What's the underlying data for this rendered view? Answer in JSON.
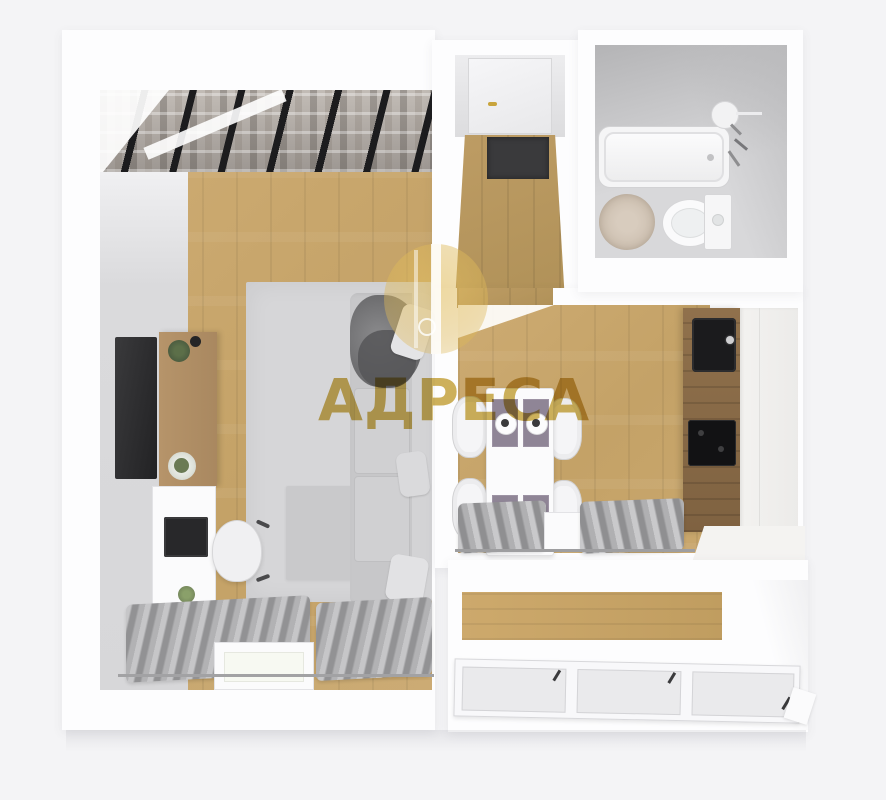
{
  "watermark": {
    "brand": "АДРЕСА",
    "icon": "lightbulb-icon",
    "brand_color": "#c9a63f"
  },
  "palette": {
    "page_background": "#f4f4f6",
    "walls_white": "#fdfdfe",
    "wood_floor": "#c9a76d",
    "hall_wood": "#b49459",
    "kitchen_counter_wood": "#8b6c49",
    "curtain_gray": "#a4a4a6",
    "appliance_dark": "#1b1b1d",
    "rug_gray": "#d6d6d8",
    "bath_rug_beige": "#cfc2b4",
    "wardrobe_frame_dark": "#1c1c1e",
    "door_handle_gold": "#c8a43c"
  }
}
